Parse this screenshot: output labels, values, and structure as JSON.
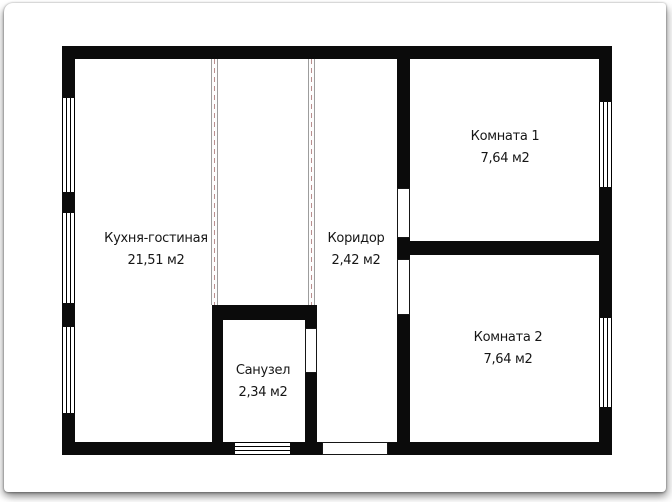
{
  "plan_title": "floor-plan",
  "rooms": [
    {
      "name": "Кухня-гостиная",
      "area": "21,51 м2"
    },
    {
      "name": "Коридор",
      "area": "2,42 м2"
    },
    {
      "name": "Санузел",
      "area": "2,34 м2"
    },
    {
      "name": "Комната 1",
      "area": "7,64 м2"
    },
    {
      "name": "Комната 2",
      "area": "7,64 м2"
    }
  ],
  "colors": {
    "wall": "#0b0b0b",
    "paper": "#ffffff",
    "text": "#161616",
    "partition_line": "#9d9d9d",
    "partition_dash": "#b98f8f"
  }
}
